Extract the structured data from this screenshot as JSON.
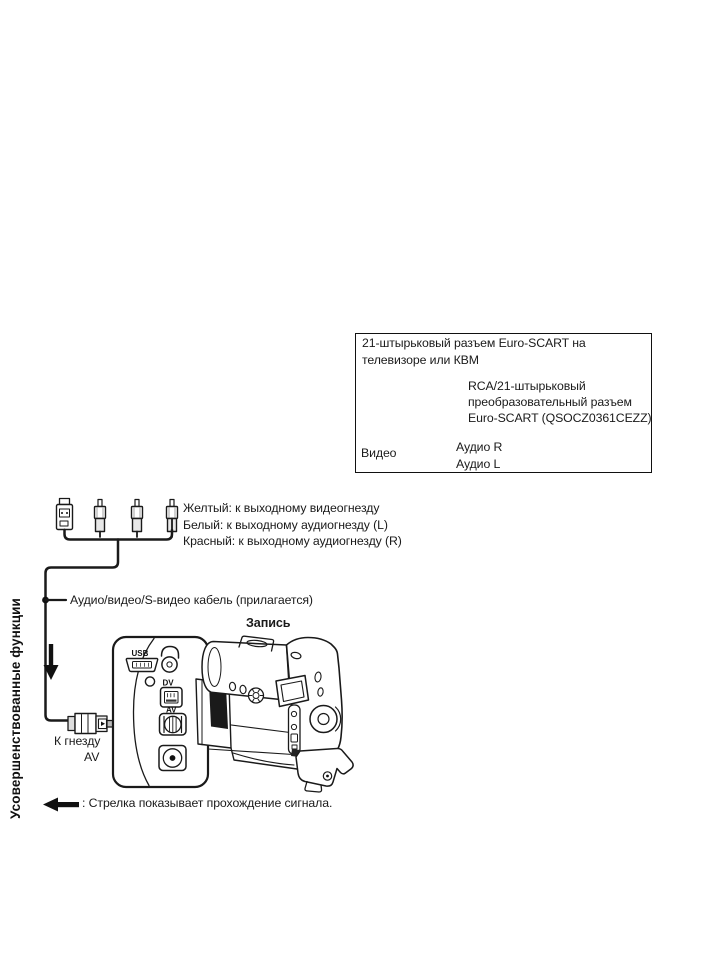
{
  "colors": {
    "ink": "#1a1a1a",
    "paper": "#ffffff"
  },
  "sidebar": {
    "label": "Усовершенствованные функции"
  },
  "scart_box": {
    "title_line1": "21-штырьковый разъем Euro-SCART на",
    "title_line2": "телевизоре или КВМ",
    "adapter_name_line1": "RCA/21-штырьковый",
    "adapter_name_line2": "преобразовательный разъем",
    "adapter_name_line3": "Euro-SCART (QSOCZ0361CEZZ)",
    "video_label": "Видео",
    "audio_r_label": "Аудио R",
    "audio_l_label": "Аудио L"
  },
  "cable": {
    "yellow_label": "Желтый: к выходному видеогнезду",
    "white_label": "Белый: к выходному аудиогнезду (L)",
    "red_label": "Красный: к выходному аудиогнезду (R)",
    "name_label": "Аудио/видео/S-видео кабель (прилагается)"
  },
  "camcorder": {
    "mode_label": "Запись",
    "port_usb": "USB",
    "port_dv": "DV",
    "port_av": "AV",
    "to_jack_line1": "К гнезду",
    "to_jack_line2": "AV"
  },
  "footer": {
    "signal_note": ": Стрелка показывает прохождение сигнала."
  }
}
